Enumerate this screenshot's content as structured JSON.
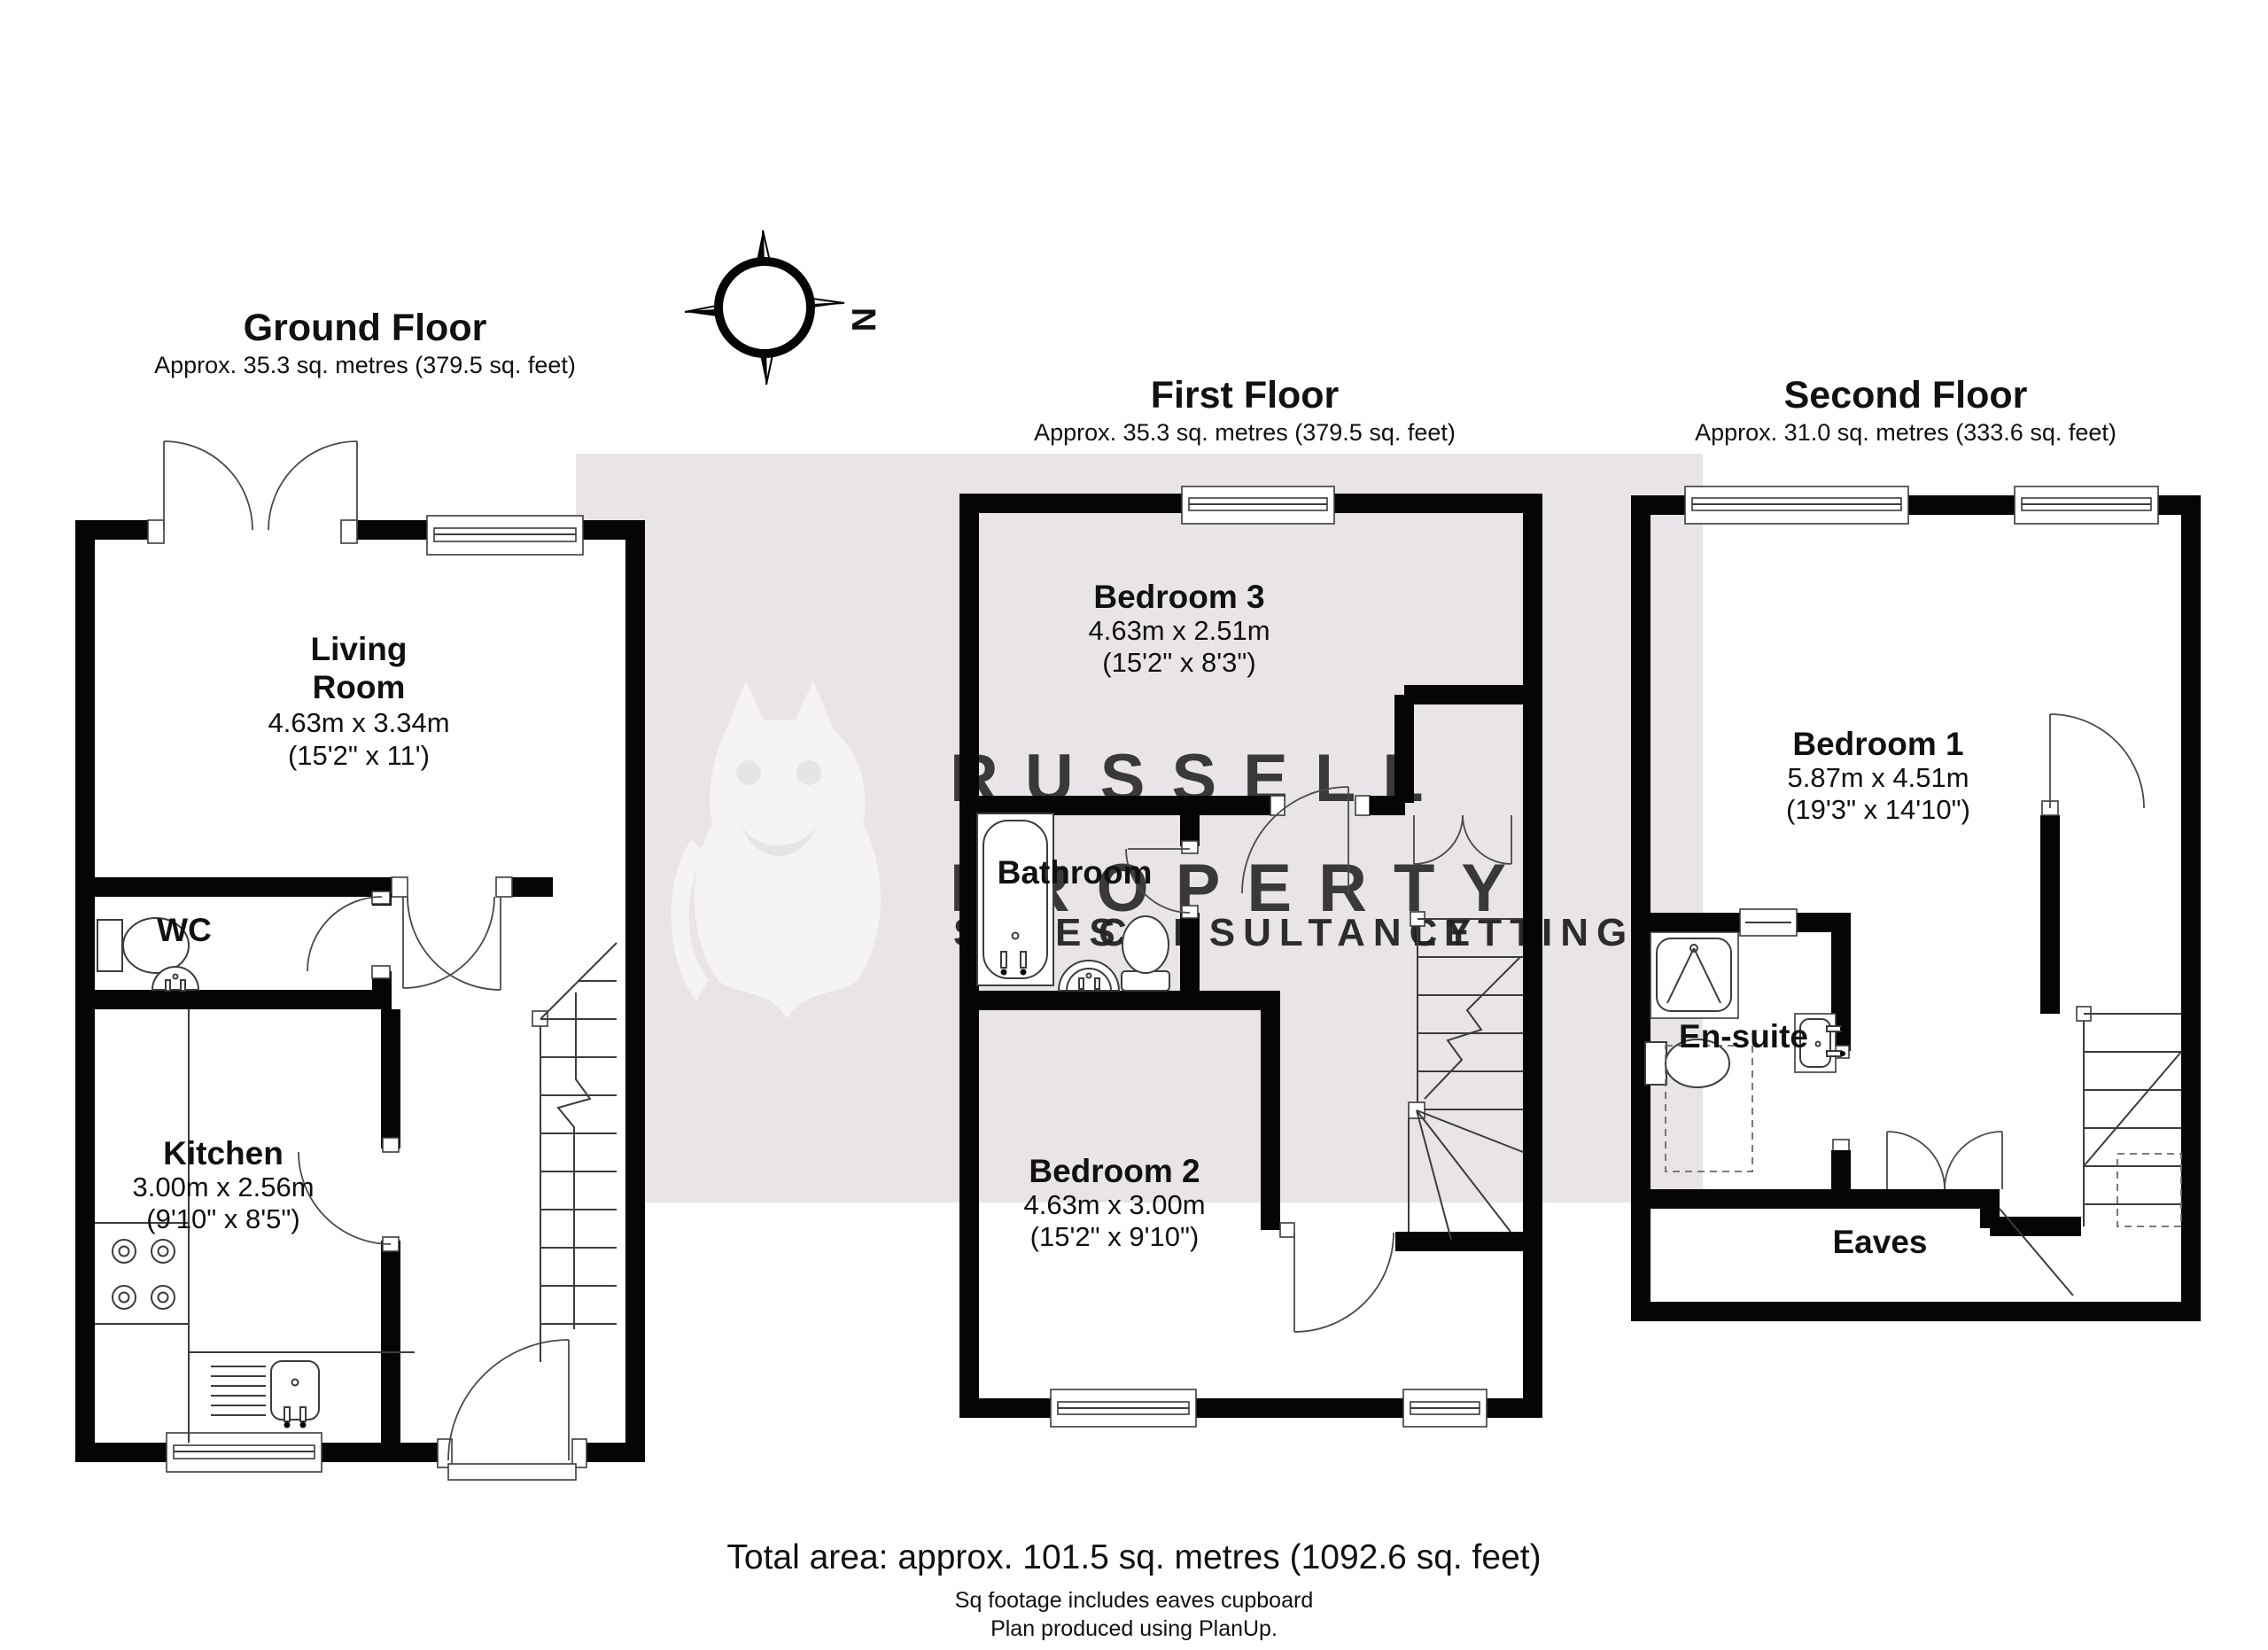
{
  "colors": {
    "band": "#e8e4e7",
    "wall": "#050505",
    "watermark_text": "#f4f2f4",
    "owl": "#f7f5f7",
    "sales": "#eef0b2",
    "consultancy": "#f8cdd6",
    "lettings": "#d7edef"
  },
  "compass": {
    "north_label": "N"
  },
  "floors": [
    {
      "title": "Ground Floor",
      "subtitle": "Approx. 35.3 sq. metres (379.5 sq. feet)"
    },
    {
      "title": "First Floor",
      "subtitle": "Approx. 35.3 sq. metres (379.5 sq. feet)"
    },
    {
      "title": "Second Floor",
      "subtitle": "Approx. 31.0 sq. metres (333.6 sq. feet)"
    }
  ],
  "rooms": {
    "living": {
      "line1": "Living",
      "line2": "Room",
      "metric": "4.63m x 3.34m",
      "imperial": "(15'2\" x 11')"
    },
    "wc": {
      "name": "WC"
    },
    "kitchen": {
      "name": "Kitchen",
      "metric": "3.00m x 2.56m",
      "imperial": "(9'10\" x 8'5\")"
    },
    "bedroom3": {
      "name": "Bedroom 3",
      "metric": "4.63m x 2.51m",
      "imperial": "(15'2\" x 8'3\")"
    },
    "bathroom": {
      "name": "Bathroom"
    },
    "bedroom2": {
      "name": "Bedroom 2",
      "metric": "4.63m x 3.00m",
      "imperial": "(15'2\" x 9'10\")"
    },
    "bedroom1": {
      "name": "Bedroom 1",
      "metric": "5.87m x 4.51m",
      "imperial": "(19'3\" x 14'10\")"
    },
    "ensuite": {
      "name": "En-suite"
    },
    "eaves": {
      "name": "Eaves"
    }
  },
  "watermark": {
    "line1": "RUSSELL",
    "line2": "PROPERTY",
    "words": [
      {
        "text": "SALES"
      },
      {
        "text": "CONSULTANCY"
      },
      {
        "text": "LETTINGS"
      }
    ]
  },
  "footer": {
    "total": "Total area: approx. 101.5 sq. metres (1092.6 sq. feet)",
    "note1": "Sq footage includes eaves cupboard",
    "note2": "Plan produced using PlanUp."
  }
}
